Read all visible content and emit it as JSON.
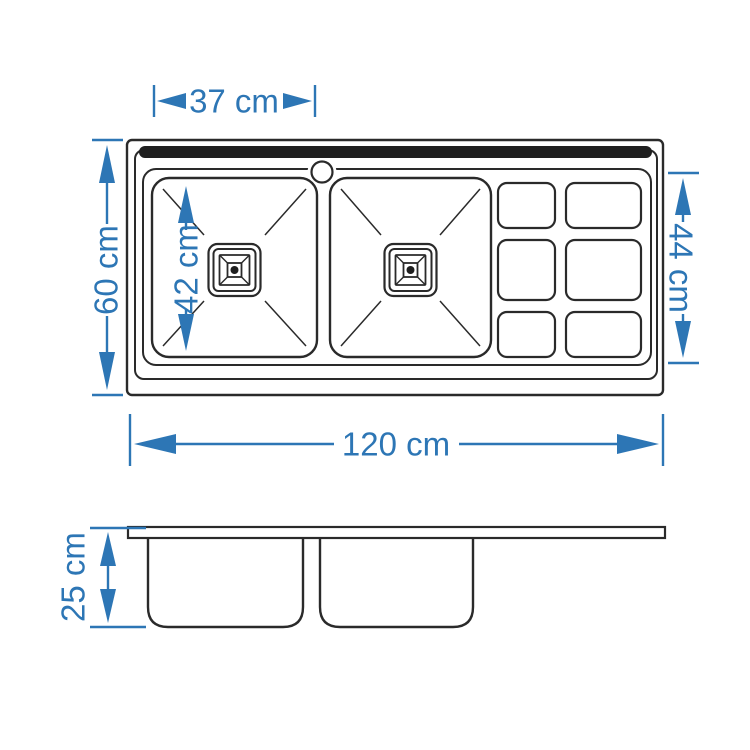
{
  "drawing": {
    "subject": "double-bowl-sink-with-drainboard",
    "views": {
      "top_view": "plan",
      "side_view": "section"
    },
    "colors": {
      "line": "#2a2a2a",
      "ledge_fill": "#1f1f1f",
      "dimension": "#2d76b5",
      "background": "#ffffff"
    }
  },
  "labels": {
    "bowl_width": "37 cm",
    "overall_depth": "60 cm",
    "bowl_length": "42 cm",
    "drainboard_depth": "44 cm",
    "overall_length": "120 cm",
    "bowl_height": "25 cm"
  }
}
